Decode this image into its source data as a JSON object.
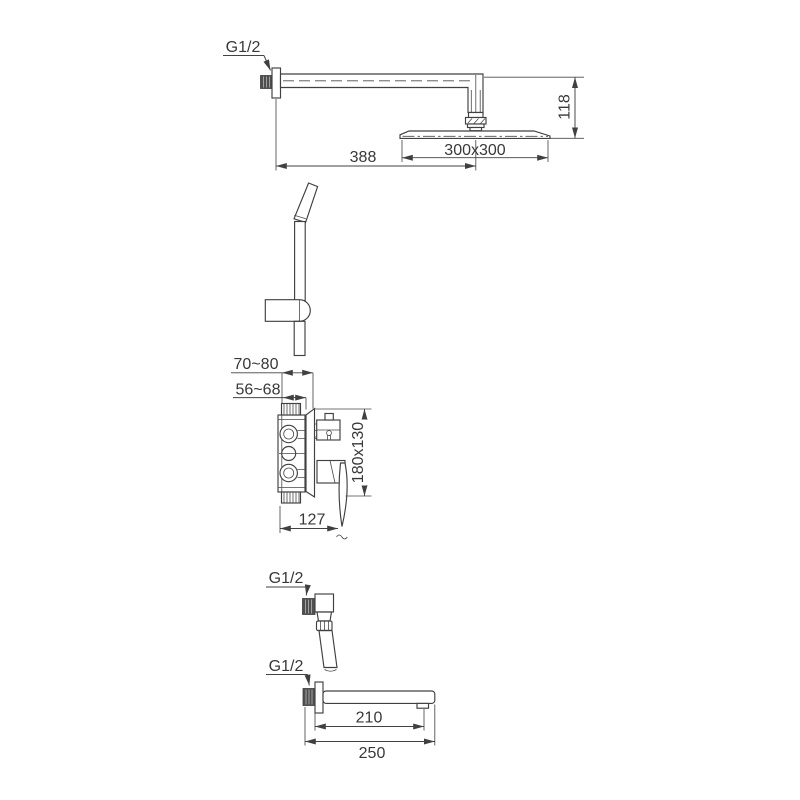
{
  "drawing": {
    "rain_shower": {
      "thread_label": "G1/2",
      "arm_length": "388",
      "head_size": "300x300",
      "drop_height": "118"
    },
    "mixer": {
      "embed_depth_max": "70~80",
      "embed_depth_min": "56~68",
      "plate_size": "180x130",
      "body_width": "127"
    },
    "wall_outlet": {
      "thread_label": "G1/2"
    },
    "spout": {
      "thread_label": "G1/2",
      "reach": "210",
      "total_length": "250"
    },
    "colors": {
      "line": "#404040",
      "dark_fill": "#4f4f4f",
      "background": "#ffffff"
    }
  }
}
